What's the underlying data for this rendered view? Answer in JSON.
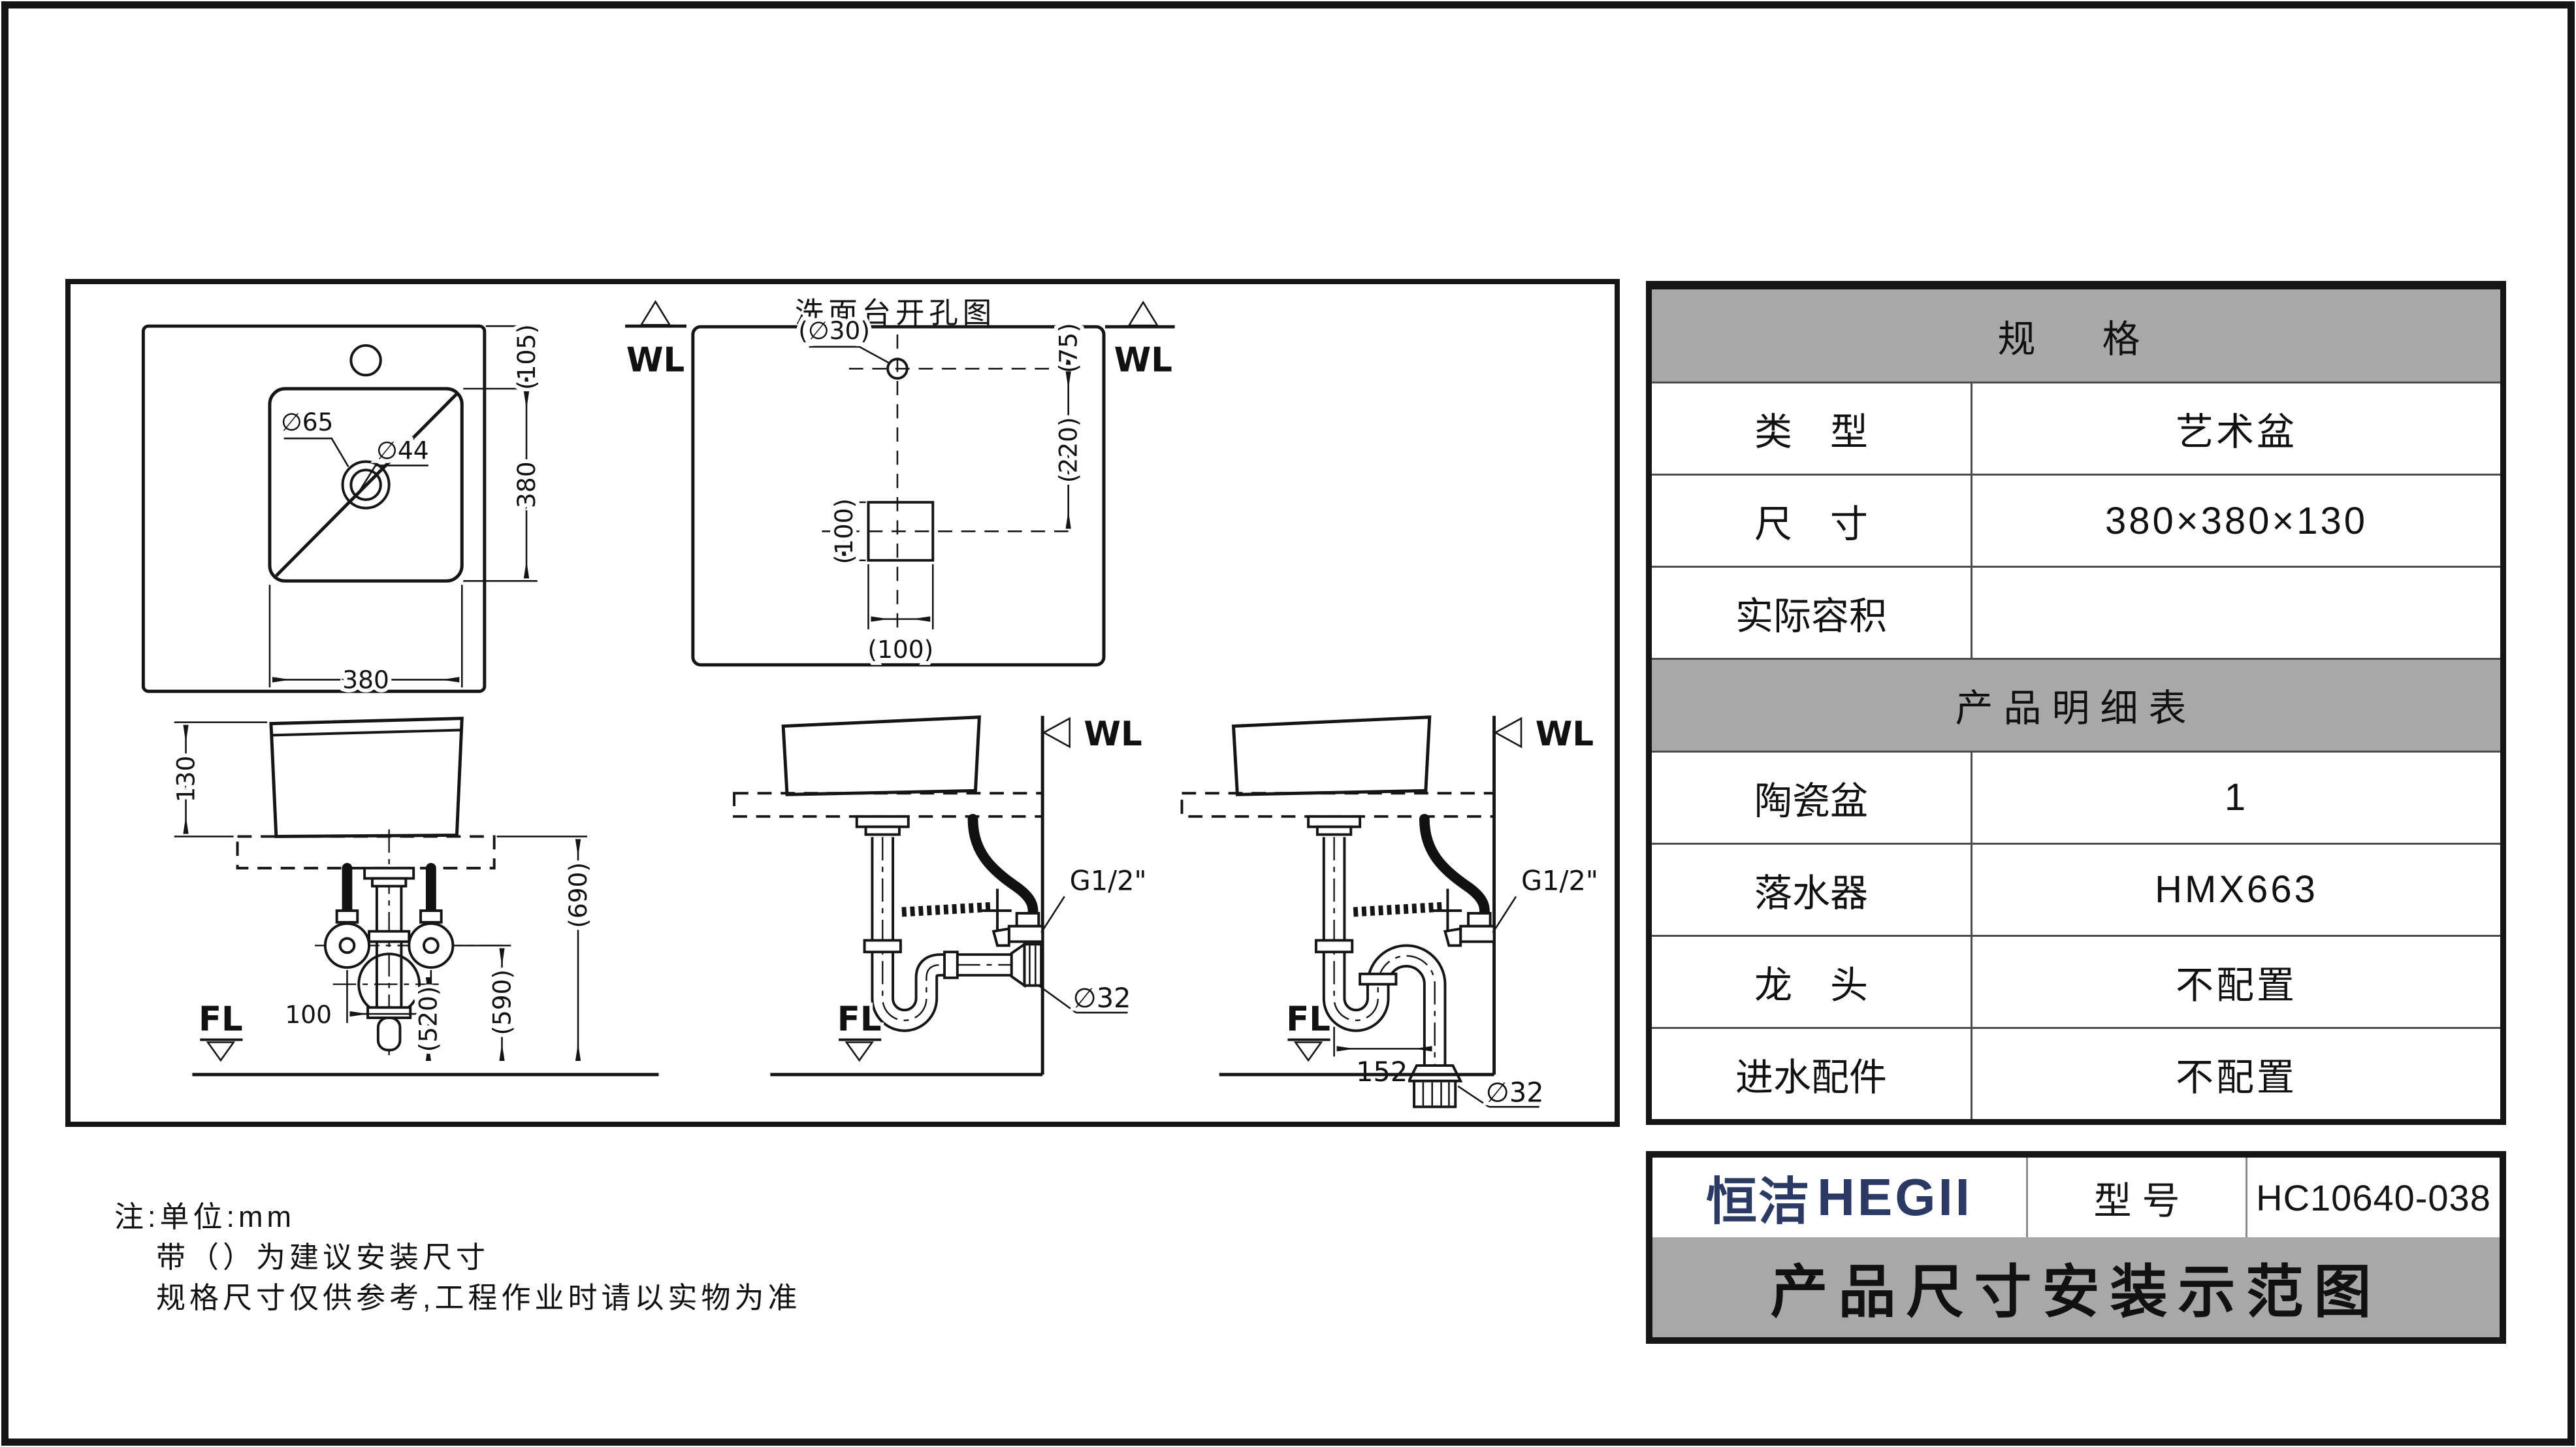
{
  "colors": {
    "table_gray": "#a8a8a8",
    "brand_navy": "#2b3a64",
    "line": "#151515"
  },
  "drawing": {
    "top_view": {
      "wl": "WL",
      "faucet_offset": "(105)",
      "basin_depth": "380",
      "basin_width": "380",
      "drain_outer_dia": "∅65",
      "drain_inner_dia": "∅44"
    },
    "hole_view": {
      "title": "洗面台开孔图",
      "wl": "WL",
      "faucet_hole_dia": "(∅30)",
      "offset_top": "(75)",
      "offset_mid": "(220)",
      "square_height": "(100)",
      "square_width": "(100)"
    },
    "front_view": {
      "basin_height": "130",
      "valve_span": "100",
      "dim_520": "(520)",
      "dim_590": "(590)",
      "dim_690": "(690)",
      "fl": "FL"
    },
    "wall_drain_view": {
      "wl": "WL",
      "thread": "G1/2\"",
      "pipe_dia": "∅32",
      "fl": "FL"
    },
    "floor_drain_view": {
      "wl": "WL",
      "thread": "G1/2\"",
      "trap_offset": "152",
      "pipe_dia": "∅32",
      "fl": "FL"
    }
  },
  "notes": {
    "line1": "注:单位:mm",
    "line2": "带（）为建议安装尺寸",
    "line3": "规格尺寸仅供参考,工程作业时请以实物为准"
  },
  "spec_table": {
    "title": "规　格",
    "rows": [
      {
        "label": "类　型",
        "value": "艺术盆"
      },
      {
        "label": "尺　寸",
        "value": "380×380×130"
      },
      {
        "label": "实际容积",
        "value": ""
      }
    ],
    "detail_title": "产品明细表",
    "detail_rows": [
      {
        "label": "陶瓷盆",
        "value": "1"
      },
      {
        "label": "落水器",
        "value": "HMX663"
      },
      {
        "label": "龙　头",
        "value": "不配置"
      },
      {
        "label": "进水配件",
        "value": "不配置"
      }
    ]
  },
  "title_block": {
    "brand_cn": "恒洁",
    "brand_en": "HEGII",
    "model_label": "型 号",
    "model_value": "HC10640-038",
    "sheet_title": "产品尺寸安装示范图"
  }
}
